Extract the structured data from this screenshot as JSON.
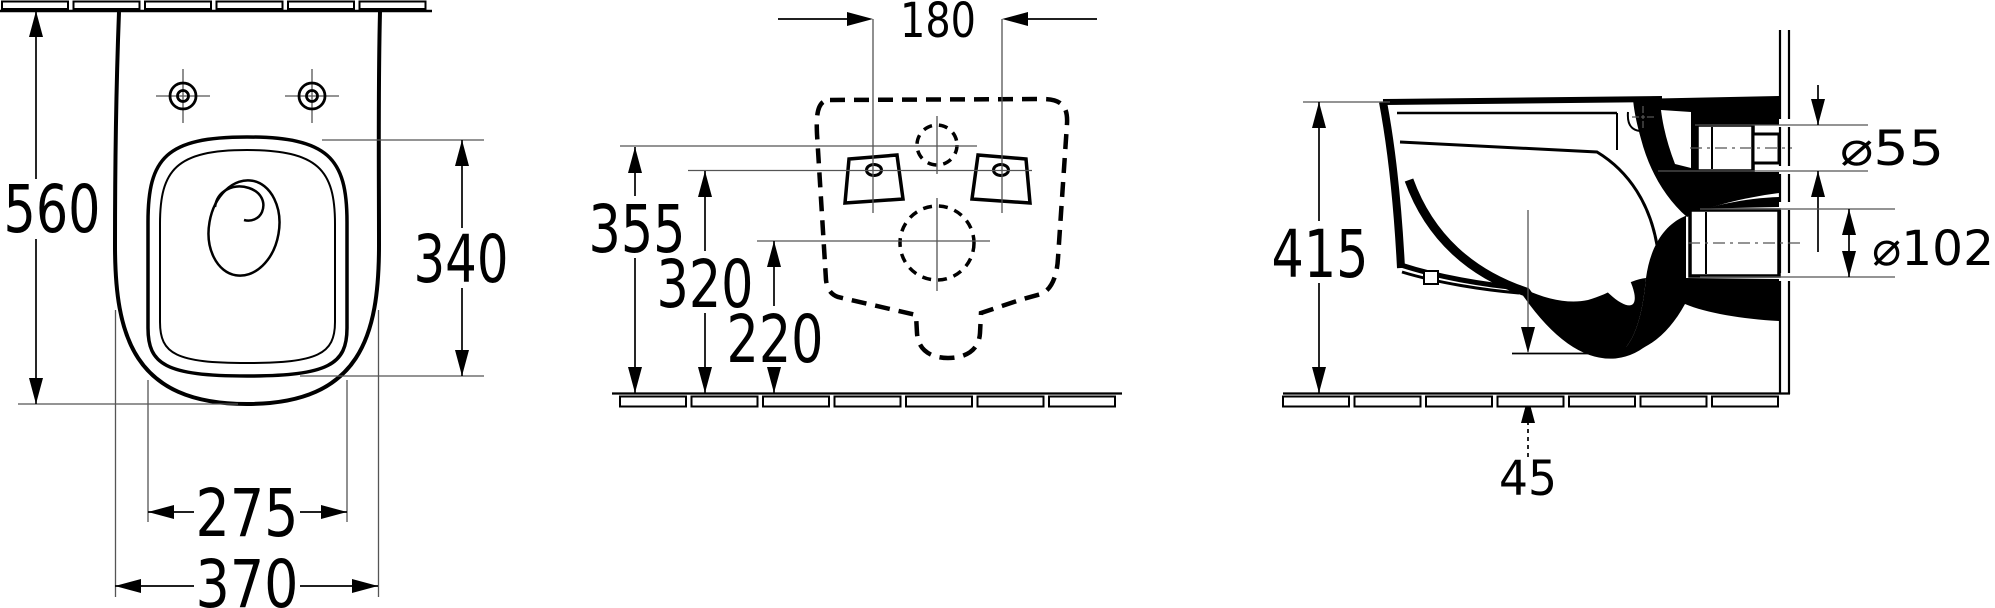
{
  "dimensions": {
    "top_view": {
      "overall_depth": "560",
      "seat_depth": "340",
      "seat_width": "275",
      "overall_width": "370"
    },
    "rear_view": {
      "bolt_spacing": "180",
      "inlet_center_height": "355",
      "bolt_height": "320",
      "outlet_center_height": "220"
    },
    "side_view": {
      "overall_height": "415",
      "inlet_diameter": "⌀55",
      "outlet_diameter": "⌀102",
      "outlet_offset": "45"
    }
  }
}
